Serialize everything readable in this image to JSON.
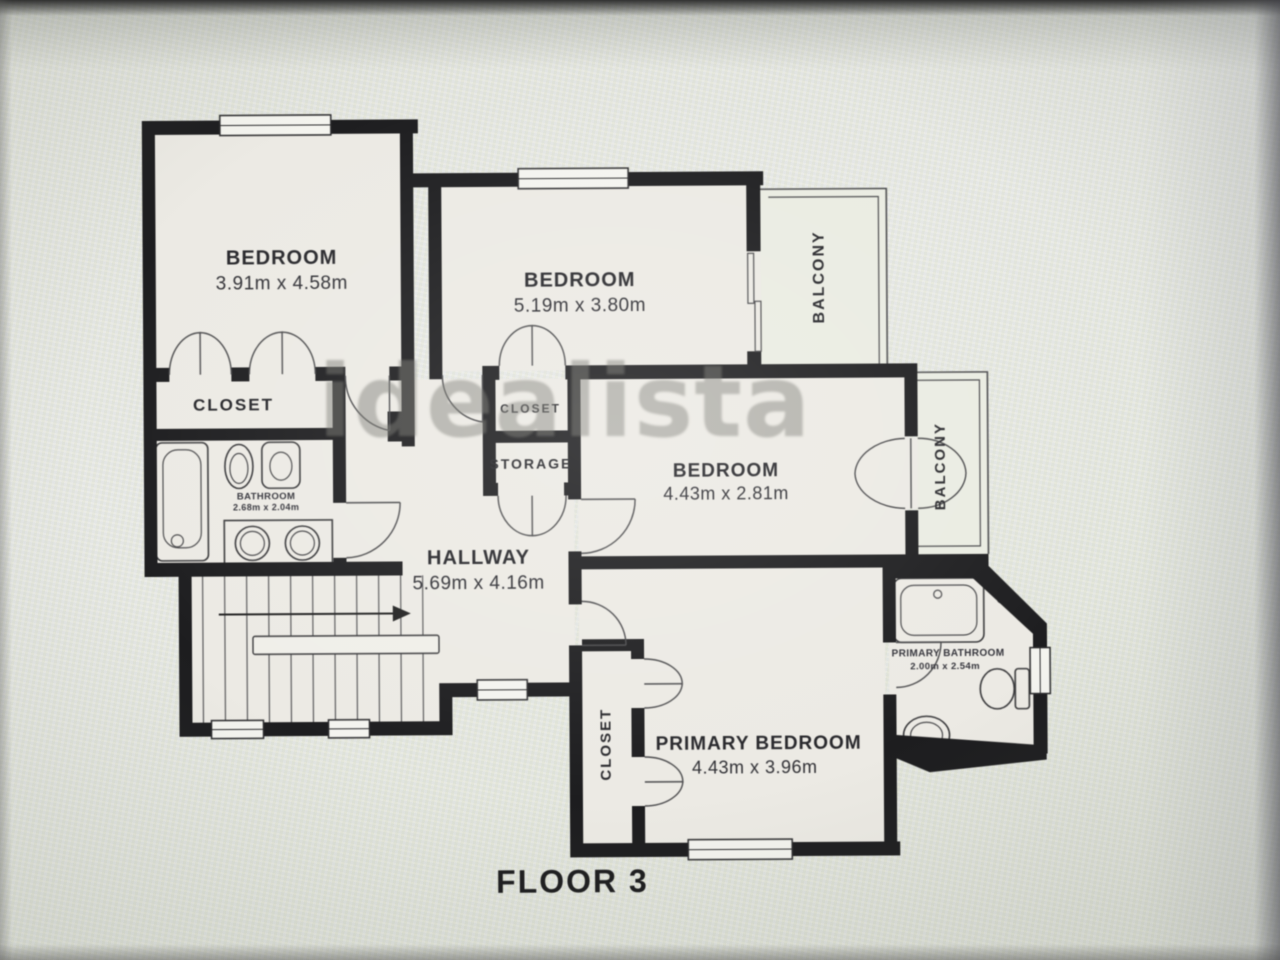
{
  "floor_label": "FLOOR 3",
  "watermark": "idealista",
  "colors": {
    "wall": "#1d1d1f",
    "floor": "#eceae4",
    "line": "#3a3a3c",
    "label": "#26262a",
    "watermark": "#767670",
    "background": "#e9eadf"
  },
  "rooms": {
    "bedroom1": {
      "name": "BEDROOM",
      "dims": "3.91m x 4.58m"
    },
    "bedroom2": {
      "name": "BEDROOM",
      "dims": "5.19m x 3.80m"
    },
    "bedroom3": {
      "name": "BEDROOM",
      "dims": "4.43m x 2.81m"
    },
    "primary_bedroom": {
      "name": "PRIMARY BEDROOM",
      "dims": "4.43m x 3.96m"
    },
    "hallway": {
      "name": "HALLWAY",
      "dims": "5.69m x 4.16m"
    },
    "bathroom": {
      "name": "BATHROOM",
      "dims": "2.68m x 2.04m"
    },
    "primary_bathroom": {
      "name": "PRIMARY BATHROOM",
      "dims": "2.00m x 2.54m"
    },
    "closet_bedroom1": {
      "name": "CLOSET"
    },
    "closet_bedroom2": {
      "name": "CLOSET"
    },
    "storage": {
      "name": "STORAGE"
    },
    "closet_primary": {
      "name": "CLOSET"
    },
    "balcony_top": {
      "name": "BALCONY"
    },
    "balcony_right": {
      "name": "BALCONY"
    }
  }
}
